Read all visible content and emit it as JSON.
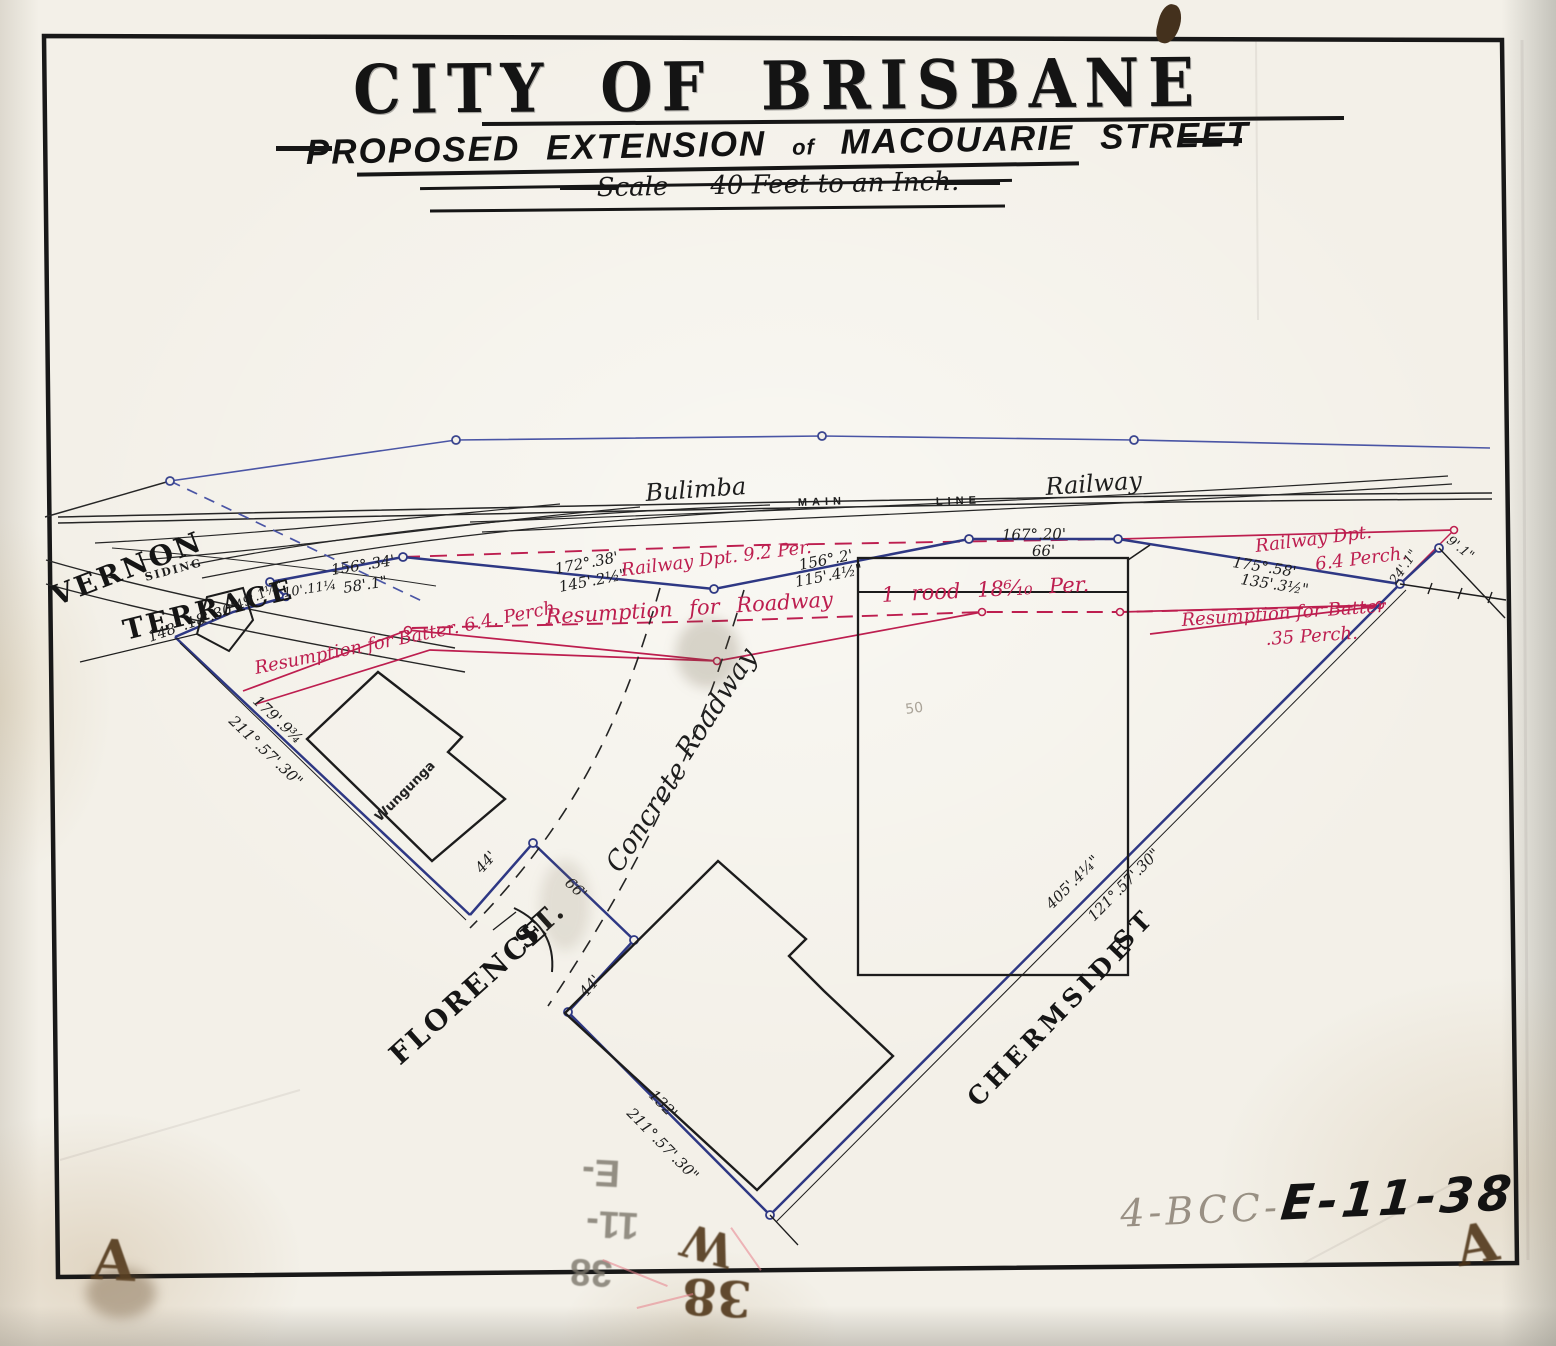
{
  "title": {
    "city": "CITY OF BRISBANE",
    "sub_1": "PROPOSED EXTENSION",
    "sub_2": "of",
    "sub_3": "MACOUARIE STREET",
    "scale_1": "Scale",
    "scale_2": "40 Feet to an Inch."
  },
  "railway": {
    "bulimba": "Bulimba",
    "main": "MAIN",
    "line": "LINE",
    "railway": "Railway"
  },
  "streets": {
    "vernon": "VERNON",
    "terrace": "TERRACE",
    "siding": "SIDING",
    "florence": "FLORENCE",
    "florence_st": "ST.",
    "chermside": "CHERMSIDE",
    "chermside_st": "ST",
    "concrete": "Concrete",
    "roadway": "Roadway",
    "wungunga": "Wungunga"
  },
  "red_notes": {
    "railway_dpt_92": "Railway Dpt. 9.2 Per.",
    "resumption_roadway_1": "Resumption for Roadway",
    "resumption_roadway_2": "1 rood 18⁶⁄₁₀ Per.",
    "batter_left": "Resumption for Batter. 6.4. Perch.",
    "railway_dpt_r1": "Railway Dpt.",
    "railway_dpt_r2": "6.4 Perch.",
    "batter_r1": "Resumption for Batter",
    "batter_r2": ".35 Perch."
  },
  "measurements": {
    "b156_34": "156°.34'",
    "d58_1": "58'.1\"",
    "d10_11": "10'.11¼",
    "d49_1": "49'.1¼\"",
    "b148": "148°.18'.30\"",
    "b172": "172°.38'",
    "d145": "145'.2½\"",
    "b156_2": "156°.2'",
    "d115": "115'.4½\"",
    "b167": "167°.20'",
    "d66": "66'",
    "b175": "175°.58'",
    "d135": "135'.3½\"",
    "d24": "24'.1\"",
    "d9": "9'.1\"",
    "d179": "179'.9¾",
    "b211a": "211°.57'.30\"",
    "d44a": "44'",
    "d66b": "66'",
    "d44b": "44'",
    "d132": "132'",
    "b211b": "211°.57'.30\"",
    "d405": "405'.4¼\"",
    "b121": "121°.57'.30\"",
    "faint_50": "50"
  },
  "stamps": {
    "ref_pencil": "4-BCC-",
    "ref_marker": "E-11-38",
    "ghost_1": "E-",
    "ghost_2": "11-",
    "ghost_3": "38",
    "mark_w": "W",
    "mark_38": "38",
    "corner_a_left": "A",
    "corner_a_right": "A"
  },
  "colors": {
    "ink": "#1c1c1c",
    "survey_blue": "#333f8e",
    "alignment_blue": "#4a55a5",
    "resumption_red": "#bd1e4f",
    "paper": "#f3f0e8",
    "pencil_gray": "#8f897e",
    "stamp_brown": "#5a3c22"
  }
}
